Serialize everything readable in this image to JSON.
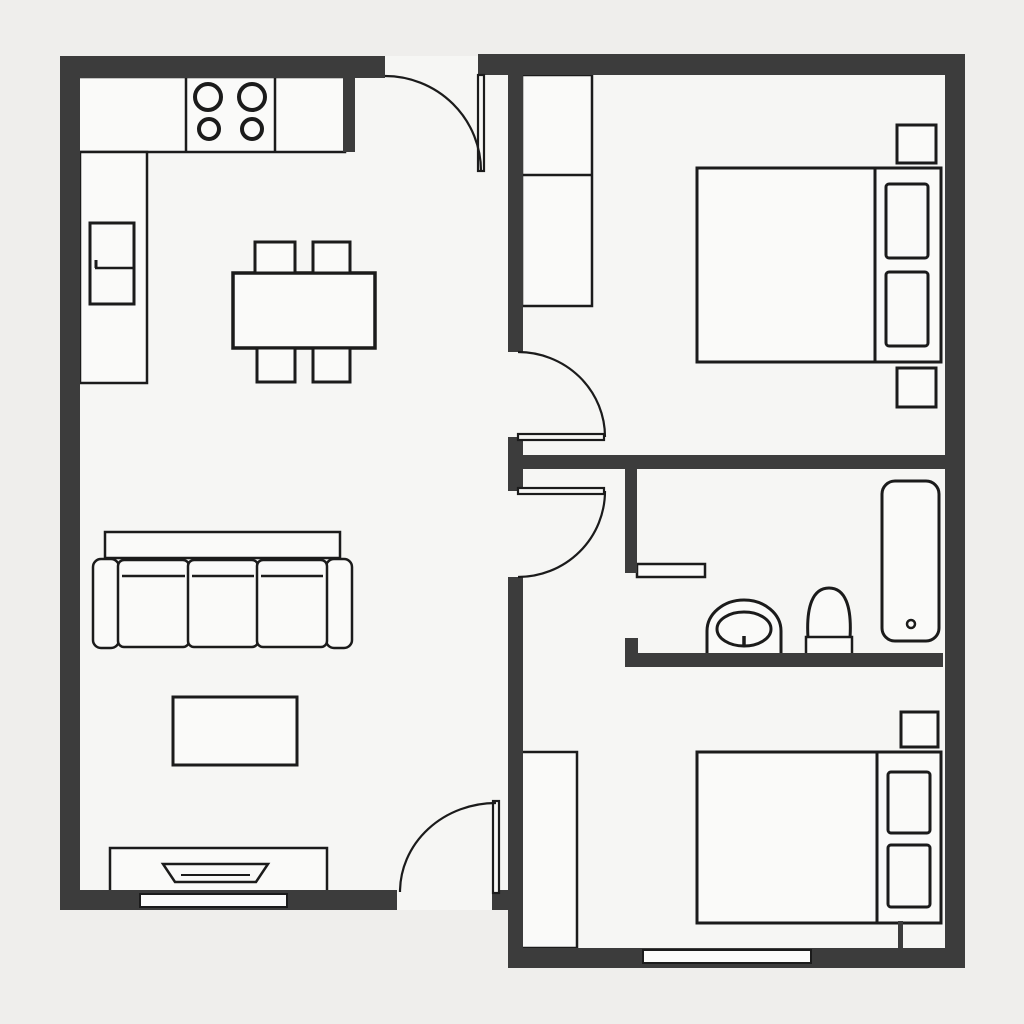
{
  "canvas": {
    "width": 1024,
    "height": 1024,
    "background_color": "#efeeec",
    "floor_color": "#f6f6f4",
    "wall_color": "#3c3c3c",
    "line_color": "#1b1b1b",
    "furniture_fill": "#fafaf9",
    "window_fill": "#fbfbfa"
  },
  "rooms": [
    {
      "name": "kitchen-dining"
    },
    {
      "name": "living-room"
    },
    {
      "name": "bedroom-top"
    },
    {
      "name": "bathroom"
    },
    {
      "name": "bedroom-bottom"
    },
    {
      "name": "hallway"
    }
  ],
  "layers": {
    "floors": [
      {
        "name": "floor-left-unit",
        "interactable": false,
        "type": "rect",
        "x": 60,
        "y": 56,
        "w": 448,
        "h": 854
      },
      {
        "name": "floor-right-unit",
        "interactable": false,
        "type": "rect",
        "x": 508,
        "y": 54,
        "w": 457,
        "h": 914
      }
    ],
    "furniture": [
      {
        "name": "kitchen-counter-top",
        "interactable": false,
        "type": "rect",
        "x": 78,
        "y": 77,
        "w": 267,
        "h": 75,
        "sw": 2.5
      },
      {
        "name": "kitchen-counter-divider-left",
        "interactable": false,
        "type": "line",
        "x1": 186,
        "y1": 77,
        "x2": 186,
        "y2": 152,
        "sw": 2.5
      },
      {
        "name": "kitchen-counter-divider-right",
        "interactable": false,
        "type": "line",
        "x1": 275,
        "y1": 77,
        "x2": 275,
        "y2": 152,
        "sw": 2.5
      },
      {
        "name": "stove-burner-top-left",
        "interactable": false,
        "type": "circle",
        "cx": 208,
        "cy": 97,
        "r": 13,
        "sw": 4
      },
      {
        "name": "stove-burner-top-right",
        "interactable": false,
        "type": "circle",
        "cx": 252,
        "cy": 97,
        "r": 13,
        "sw": 4
      },
      {
        "name": "stove-burner-bottom-left",
        "interactable": false,
        "type": "circle",
        "cx": 209,
        "cy": 129,
        "r": 10,
        "sw": 4
      },
      {
        "name": "stove-burner-bottom-right",
        "interactable": false,
        "type": "circle",
        "cx": 252,
        "cy": 129,
        "r": 10,
        "sw": 4
      },
      {
        "name": "kitchen-counter-left-column",
        "interactable": false,
        "type": "rect",
        "x": 80,
        "y": 152,
        "w": 67,
        "h": 231,
        "sw": 2.5
      },
      {
        "name": "fridge",
        "interactable": false,
        "type": "rect",
        "x": 90,
        "y": 223,
        "w": 44,
        "h": 81,
        "sw": 3
      },
      {
        "name": "fridge-divider",
        "interactable": false,
        "type": "line",
        "x1": 95,
        "y1": 268,
        "x2": 134,
        "y2": 268,
        "sw": 2.5
      },
      {
        "name": "fridge-handle",
        "interactable": false,
        "type": "line",
        "x1": 96,
        "y1": 260,
        "x2": 96,
        "y2": 268,
        "sw": 3
      },
      {
        "name": "dining-table",
        "interactable": false,
        "type": "rect",
        "x": 233,
        "y": 273,
        "w": 142,
        "h": 75,
        "sw": 3.5
      },
      {
        "name": "dining-chair-top-left",
        "interactable": false,
        "type": "rect",
        "x": 255,
        "y": 242,
        "w": 40,
        "h": 31,
        "sw": 3
      },
      {
        "name": "dining-chair-top-right",
        "interactable": false,
        "type": "rect",
        "x": 313,
        "y": 242,
        "w": 37,
        "h": 31,
        "sw": 3
      },
      {
        "name": "dining-chair-bottom-left",
        "interactable": false,
        "type": "rect",
        "x": 257,
        "y": 348,
        "w": 38,
        "h": 34,
        "sw": 3
      },
      {
        "name": "dining-chair-bottom-right",
        "interactable": false,
        "type": "rect",
        "x": 313,
        "y": 348,
        "w": 37,
        "h": 34,
        "sw": 3
      },
      {
        "name": "sofa-backrest",
        "interactable": false,
        "type": "rect",
        "x": 105,
        "y": 532,
        "w": 235,
        "h": 26,
        "sw": 2.5
      },
      {
        "name": "sofa-armrest-left",
        "interactable": false,
        "type": "rect",
        "x": 93,
        "y": 559,
        "w": 26,
        "h": 89,
        "rx": 8,
        "sw": 2.5
      },
      {
        "name": "sofa-armrest-right",
        "interactable": false,
        "type": "rect",
        "x": 326,
        "y": 559,
        "w": 26,
        "h": 89,
        "rx": 8,
        "sw": 2.5
      },
      {
        "name": "sofa-cushion-left",
        "interactable": false,
        "type": "rect",
        "x": 118,
        "y": 560,
        "w": 71,
        "h": 87,
        "rx": 6,
        "sw": 2.5
      },
      {
        "name": "sofa-cushion-middle",
        "interactable": false,
        "type": "rect",
        "x": 188,
        "y": 560,
        "w": 70,
        "h": 87,
        "rx": 6,
        "sw": 2.5
      },
      {
        "name": "sofa-cushion-right",
        "interactable": false,
        "type": "rect",
        "x": 257,
        "y": 560,
        "w": 70,
        "h": 87,
        "rx": 6,
        "sw": 2.5
      },
      {
        "name": "sofa-cushion-left-seam",
        "interactable": false,
        "type": "line",
        "x1": 122,
        "y1": 576,
        "x2": 185,
        "y2": 576,
        "sw": 2.5
      },
      {
        "name": "sofa-cushion-middle-seam",
        "interactable": false,
        "type": "line",
        "x1": 192,
        "y1": 576,
        "x2": 254,
        "y2": 576,
        "sw": 2.5
      },
      {
        "name": "sofa-cushion-right-seam",
        "interactable": false,
        "type": "line",
        "x1": 261,
        "y1": 576,
        "x2": 323,
        "y2": 576,
        "sw": 2.5
      },
      {
        "name": "coffee-table",
        "interactable": false,
        "type": "rect",
        "x": 173,
        "y": 697,
        "w": 124,
        "h": 68,
        "sw": 3
      },
      {
        "name": "tv-console",
        "interactable": false,
        "type": "rect",
        "x": 110,
        "y": 848,
        "w": 217,
        "h": 49,
        "sw": 2.5
      },
      {
        "name": "tv-screen",
        "interactable": false,
        "type": "polygon",
        "points": "163,864 268,864 256,882 175,882",
        "sw": 2.5
      },
      {
        "name": "tv-screen-inner-line",
        "interactable": false,
        "type": "line",
        "x1": 181,
        "y1": 875,
        "x2": 250,
        "y2": 875,
        "sw": 2
      },
      {
        "name": "wardrobe-bedroom-top",
        "interactable": false,
        "type": "rect",
        "x": 522,
        "y": 75,
        "w": 70,
        "h": 231,
        "sw": 2.5
      },
      {
        "name": "wardrobe-bedroom-top-divider",
        "interactable": false,
        "type": "line",
        "x1": 522,
        "y1": 175,
        "x2": 592,
        "y2": 175,
        "sw": 2.5
      },
      {
        "name": "bed-top",
        "interactable": false,
        "type": "rect",
        "x": 697,
        "y": 168,
        "w": 244,
        "h": 194,
        "sw": 3
      },
      {
        "name": "bed-top-headboard-divider",
        "interactable": false,
        "type": "line",
        "x1": 875,
        "y1": 168,
        "x2": 875,
        "y2": 362,
        "sw": 3
      },
      {
        "name": "bed-top-pillow-upper",
        "interactable": false,
        "type": "rect",
        "x": 886,
        "y": 184,
        "w": 42,
        "h": 74,
        "rx": 3,
        "sw": 3
      },
      {
        "name": "bed-top-pillow-lower",
        "interactable": false,
        "type": "rect",
        "x": 886,
        "y": 272,
        "w": 42,
        "h": 74,
        "rx": 3,
        "sw": 3
      },
      {
        "name": "nightstand-top-bedroom-upper",
        "interactable": false,
        "type": "rect",
        "x": 897,
        "y": 125,
        "w": 39,
        "h": 38,
        "sw": 3
      },
      {
        "name": "nightstand-top-bedroom-lower",
        "interactable": false,
        "type": "rect",
        "x": 897,
        "y": 368,
        "w": 39,
        "h": 39,
        "sw": 3
      },
      {
        "name": "bathroom-vanity-shelf",
        "interactable": false,
        "type": "rect",
        "x": 637,
        "y": 564,
        "w": 68,
        "h": 13,
        "sw": 2.5
      },
      {
        "name": "sink-pedestal",
        "interactable": false,
        "type": "path",
        "d": "M 707 657 L 707 631 A 37 31 0 0 1 781 631 L 781 657",
        "sw": 3
      },
      {
        "name": "sink-basin",
        "interactable": false,
        "type": "ellipse",
        "cx": 744,
        "cy": 629,
        "rx": 27,
        "ry": 17,
        "sw": 3
      },
      {
        "name": "sink-tap",
        "interactable": false,
        "type": "line",
        "x1": 744,
        "y1": 636,
        "x2": 744,
        "y2": 645,
        "sw": 3.5
      },
      {
        "name": "toilet-bowl",
        "interactable": false,
        "type": "path",
        "d": "M 808 638 C 806 606 813 588 829 588 C 845 588 852 606 850 638 Z",
        "sw": 3
      },
      {
        "name": "toilet-tank",
        "interactable": false,
        "type": "rect",
        "x": 806,
        "y": 637,
        "w": 46,
        "h": 19,
        "sw": 2.5
      },
      {
        "name": "bathtub",
        "interactable": false,
        "type": "rect",
        "x": 882,
        "y": 481,
        "w": 57,
        "h": 160,
        "rx": 13,
        "sw": 3
      },
      {
        "name": "bathtub-drain",
        "interactable": false,
        "type": "circle",
        "cx": 911,
        "cy": 624,
        "r": 4,
        "sw": 2.5
      },
      {
        "name": "closet-bedroom-bottom",
        "interactable": false,
        "type": "rect",
        "x": 521,
        "y": 752,
        "w": 56,
        "h": 196,
        "sw": 2.5
      },
      {
        "name": "bed-bottom",
        "interactable": false,
        "type": "rect",
        "x": 697,
        "y": 752,
        "w": 244,
        "h": 171,
        "sw": 3
      },
      {
        "name": "bed-bottom-headboard-divider",
        "interactable": false,
        "type": "line",
        "x1": 877,
        "y1": 752,
        "x2": 877,
        "y2": 923,
        "sw": 3
      },
      {
        "name": "bed-bottom-pillow-upper",
        "interactable": false,
        "type": "rect",
        "x": 888,
        "y": 772,
        "w": 42,
        "h": 61,
        "rx": 3,
        "sw": 3
      },
      {
        "name": "bed-bottom-pillow-lower",
        "interactable": false,
        "type": "rect",
        "x": 888,
        "y": 845,
        "w": 42,
        "h": 62,
        "rx": 3,
        "sw": 3
      },
      {
        "name": "nightstand-bottom-bedroom",
        "interactable": false,
        "type": "rect",
        "x": 901,
        "y": 712,
        "w": 37,
        "h": 35,
        "sw": 3
      }
    ],
    "walls": [
      {
        "name": "wall-exterior-left",
        "interactable": false,
        "type": "rect",
        "x": 60,
        "y": 56,
        "w": 20,
        "h": 854
      },
      {
        "name": "wall-exterior-top-left",
        "interactable": false,
        "type": "rect",
        "x": 60,
        "y": 56,
        "w": 325,
        "h": 22
      },
      {
        "name": "wall-exterior-bottom-left",
        "interactable": false,
        "type": "rect",
        "x": 60,
        "y": 890,
        "w": 337,
        "h": 20
      },
      {
        "name": "wall-exterior-bottom-left-jamb",
        "interactable": false,
        "type": "rect",
        "x": 492,
        "y": 890,
        "w": 31,
        "h": 20
      },
      {
        "name": "wall-exterior-top-right",
        "interactable": false,
        "type": "rect",
        "x": 478,
        "y": 54,
        "w": 487,
        "h": 21
      },
      {
        "name": "wall-exterior-right",
        "interactable": false,
        "type": "rect",
        "x": 945,
        "y": 54,
        "w": 20,
        "h": 914
      },
      {
        "name": "wall-exterior-bottom-right",
        "interactable": false,
        "type": "rect",
        "x": 508,
        "y": 948,
        "w": 457,
        "h": 20
      },
      {
        "name": "wall-divider-upper",
        "interactable": false,
        "type": "rect",
        "x": 508,
        "y": 75,
        "w": 15,
        "h": 277
      },
      {
        "name": "wall-divider-middle",
        "interactable": false,
        "type": "rect",
        "x": 508,
        "y": 437,
        "w": 15,
        "h": 54
      },
      {
        "name": "wall-divider-lower",
        "interactable": false,
        "type": "rect",
        "x": 508,
        "y": 577,
        "w": 15,
        "h": 390
      },
      {
        "name": "wall-hallway-bathroom-top",
        "interactable": false,
        "type": "rect",
        "x": 520,
        "y": 455,
        "w": 425,
        "h": 14
      },
      {
        "name": "wall-kitchen-stub",
        "interactable": false,
        "type": "rect",
        "x": 343,
        "y": 75,
        "w": 12,
        "h": 77
      },
      {
        "name": "wall-bathroom-left",
        "interactable": false,
        "type": "rect",
        "x": 625,
        "y": 469,
        "w": 12,
        "h": 104
      },
      {
        "name": "wall-bathroom-bottom",
        "interactable": false,
        "type": "rect",
        "x": 625,
        "y": 653,
        "w": 318,
        "h": 14
      },
      {
        "name": "wall-bathroom-bottom-stub",
        "interactable": false,
        "type": "rect",
        "x": 625,
        "y": 638,
        "w": 13,
        "h": 15
      },
      {
        "name": "wall-bed-bottom-stub",
        "interactable": false,
        "type": "rect",
        "x": 898,
        "y": 921,
        "w": 5,
        "h": 27
      }
    ],
    "windows": [
      {
        "name": "window-living-room",
        "interactable": false,
        "type": "rect",
        "x": 140,
        "y": 894,
        "w": 147,
        "h": 13,
        "sw": 2
      },
      {
        "name": "window-bedroom-bottom",
        "interactable": false,
        "type": "rect",
        "x": 643,
        "y": 950,
        "w": 168,
        "h": 13,
        "sw": 2
      }
    ],
    "doors": [
      {
        "name": "entry-door-leaf",
        "interactable": false,
        "type": "rect",
        "x": 478,
        "y": 75,
        "w": 6,
        "h": 96,
        "sw": 2.2
      },
      {
        "name": "entry-door-swing-arc",
        "interactable": false,
        "type": "path",
        "d": "M 385 76 A 96 95 0 0 1 481 171",
        "sw": 2.2,
        "fill": "none"
      },
      {
        "name": "bedroom-top-door-leaf",
        "interactable": false,
        "type": "rect",
        "x": 518,
        "y": 434,
        "w": 86,
        "h": 6,
        "sw": 2.2
      },
      {
        "name": "bedroom-top-door-swing-arc",
        "interactable": false,
        "type": "path",
        "d": "M 518 352 A 87 85 0 0 1 605 437",
        "sw": 2.2,
        "fill": "none"
      },
      {
        "name": "hallway-door-leaf",
        "interactable": false,
        "type": "rect",
        "x": 518,
        "y": 488,
        "w": 86,
        "h": 6,
        "sw": 2.2
      },
      {
        "name": "hallway-door-swing-arc",
        "interactable": false,
        "type": "path",
        "d": "M 605 491 A 87 86 0 0 1 518 577",
        "sw": 2.2,
        "fill": "none"
      },
      {
        "name": "living-room-south-door-leaf",
        "interactable": false,
        "type": "rect",
        "x": 493,
        "y": 801,
        "w": 6,
        "h": 92,
        "sw": 2.2
      },
      {
        "name": "living-room-south-door-swing-arc",
        "interactable": false,
        "type": "path",
        "d": "M 496 803 A 96 89 0 0 0 400 892",
        "sw": 2.2,
        "fill": "none"
      }
    ]
  }
}
